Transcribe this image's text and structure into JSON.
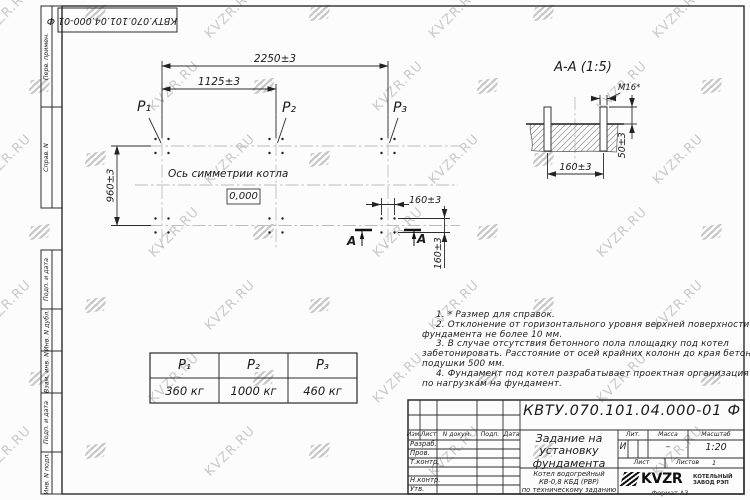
{
  "watermark": {
    "text": "KVZR.RU"
  },
  "colors": {
    "line": "#2b2b2b",
    "watermark": "#c9c9c9",
    "centerline": "#bdbdbd"
  },
  "corner_stamp": {
    "doc_number": "КВТУ.070.101.04.000-01  Ф"
  },
  "margin_labels": {
    "perv_primen": "Перв. примен.",
    "sprav_n": "Справ. N",
    "podp_i_data_1": "Подп. и дата",
    "inv_n_dubl": "Инв. N дубл.",
    "vzam_inv_n": "Взам. инв. N",
    "podp_i_data_2": "Подп. и дата",
    "inv_n_podl": "Инв. N подл."
  },
  "plan": {
    "dim_width_total": "2250±3",
    "dim_width_half": "1125±3",
    "dim_depth": "960±3",
    "dim_bolt_h": "160±3",
    "dim_bolt_v": "160±3",
    "label_p1": "P₁",
    "label_p2": "P₂",
    "label_p3": "P₃",
    "axis_label": "Ось симметрии котла",
    "elevation_mark": "0,000",
    "section_letter_left": "А",
    "section_letter_right": "А"
  },
  "section_view": {
    "title": "А-А (1:5)",
    "bolt_thread": "M16*",
    "dim_bolt_spacing": "160±3",
    "dim_protrusion": "50±3"
  },
  "notes": {
    "lines": [
      "1. * Размер для справок.",
      "2. Отклонение от горизонтального уровня верхней поверхности",
      "фундамента не более 10 мм.",
      "3. В случае отсутствия бетонного пола площадку под котел",
      "забетонировать. Расстояние от осей крайних колонн до края бетонной",
      "подушки 500 мм.",
      "4. Фундамент под котел разрабатывает проектная организация",
      "по нагрузкам на фундамент."
    ]
  },
  "load_table": {
    "headers": [
      "P₁",
      "P₂",
      "P₃"
    ],
    "values": [
      "360 кг",
      "1000 кг",
      "460 кг"
    ]
  },
  "title_block": {
    "doc_number": "КВТУ.070.101.04.000-01  Ф",
    "name_lines": [
      "Задание на",
      "установку",
      "фундамента"
    ],
    "product_lines": [
      "Котел водогрейный",
      "КВ-0,8 КБД (РВР)",
      "по техническому заданию"
    ],
    "col_izm": "Изм.",
    "col_list": "Лист",
    "col_ndok": "N докум.",
    "col_podp": "Подп.",
    "col_data": "Дата",
    "row_razrab": "Разраб.",
    "row_prov": "Пров.",
    "row_tkontr": "Т.контр.",
    "row_nkontr": "Н.контр.",
    "row_utv": "Утв.",
    "lit_label": "Лит.",
    "mass_label": "Масса",
    "scale_label": "Масштаб",
    "lit_value": "И",
    "mass_value": "–",
    "scale_value": "1:20",
    "sheet_label": "Лист",
    "sheets_label": "Листов",
    "sheets_value": "1",
    "brand": "KVZR",
    "brand_caption_1": "КОТЕЛЬНЫЙ",
    "brand_caption_2": "ЗАВОД РЭП",
    "format_note": "Формат А3"
  }
}
